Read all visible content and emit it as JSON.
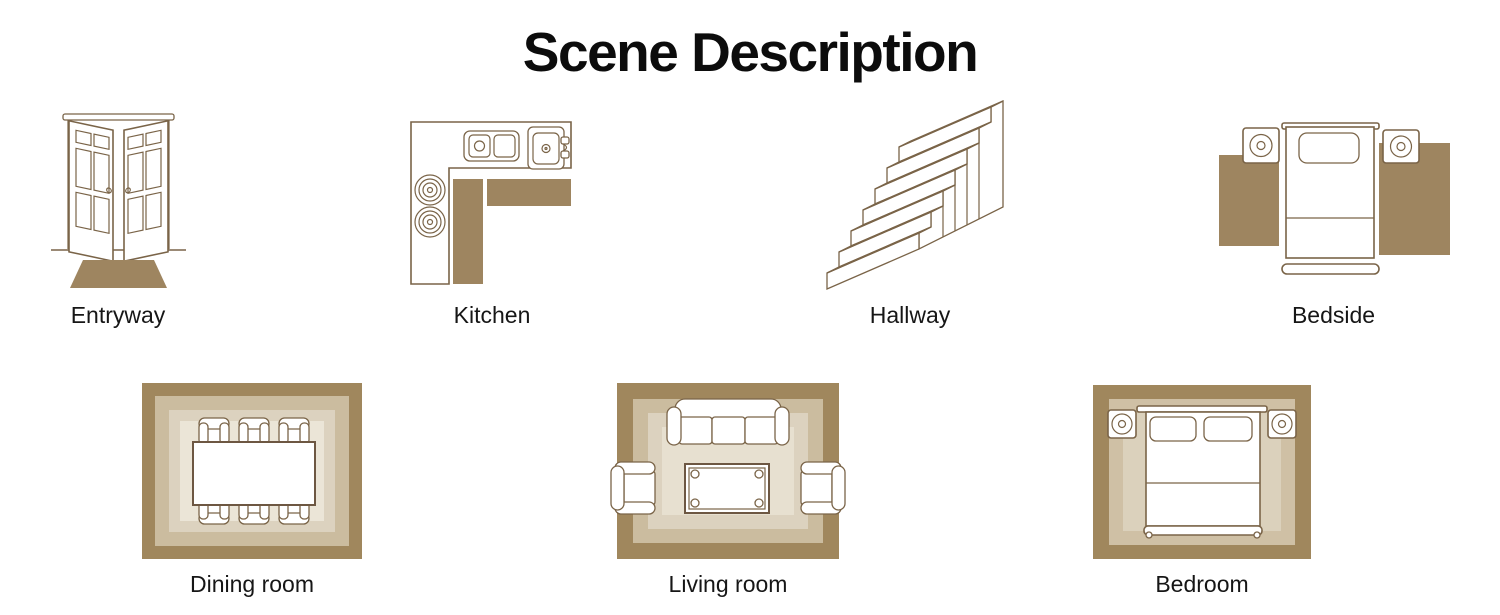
{
  "title": "Scene Description",
  "palette": {
    "line_brown": "#7a6448",
    "solid_brown": "#9e8560",
    "rug_outer": "#a0875d",
    "rug_mid": "#cbbc9f",
    "rug_inner": "#dcd2bf",
    "rug_center": "#ebe5d7",
    "text_color": "#161616",
    "background": "#ffffff"
  },
  "scenes": [
    {
      "label": "Entryway",
      "icon": "open-double-doors-with-doormat-icon"
    },
    {
      "label": "Kitchen",
      "icon": "l-shaped-kitchen-counter-with-runner-rug-icon"
    },
    {
      "label": "Hallway",
      "icon": "staircase-icon"
    },
    {
      "label": "Bedside",
      "icon": "single-bed-with-nightstands-and-side-rugs-icon"
    },
    {
      "label": "Dining room",
      "icon": "dining-table-with-six-chairs-on-rug-icon"
    },
    {
      "label": "Living room",
      "icon": "sofa-armchairs-coffee-table-on-rug-icon"
    },
    {
      "label": "Bedroom",
      "icon": "double-bed-with-nightstands-on-rug-icon"
    }
  ]
}
